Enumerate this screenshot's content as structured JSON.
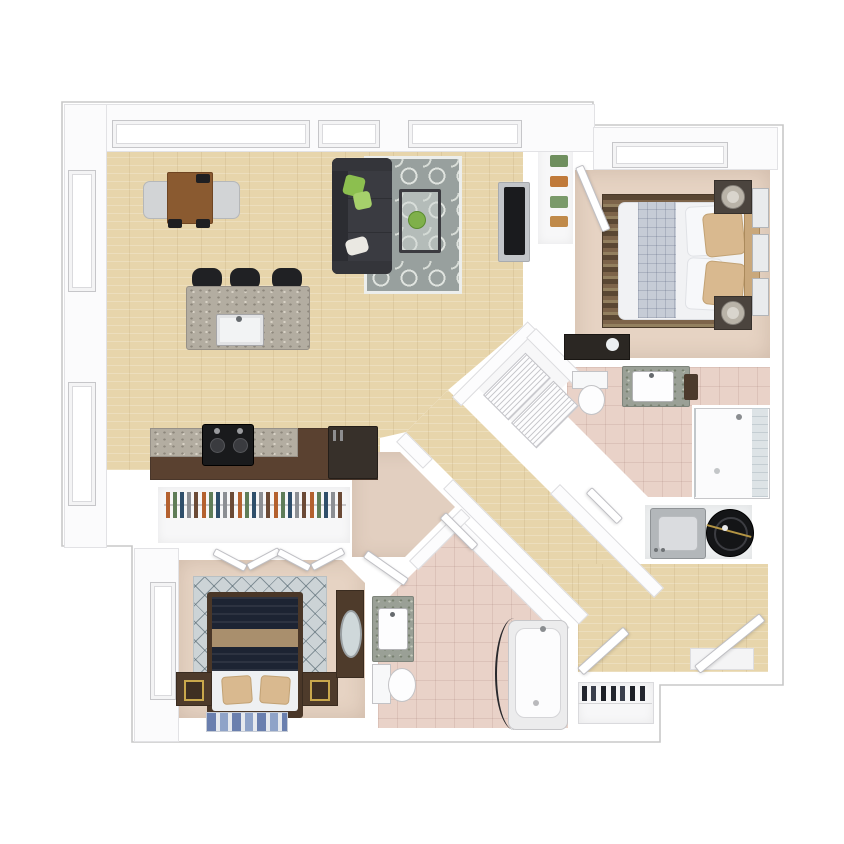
{
  "scene": {
    "type": "3d-floor-plan-render",
    "view": "top-down",
    "description": "Two bedroom, two bathroom apartment rendered in 3D top-down view on white background"
  },
  "palette": {
    "background": "#ffffff",
    "outline": "#c8c8c8",
    "wall": "#fbfbfc",
    "wood_floor": "#e7d5ab",
    "carpet_bedroom": "#e6d3c3",
    "carpet_vestibule": "#e2cfc0",
    "tile_bath": "#e9d2c8",
    "closet_floor": "#f7f7f8",
    "utility_floor": "#eef0f1",
    "sofa": "#3a3b41",
    "rug_living": "#98a09e",
    "dining_table": "#8a5a30",
    "dining_chair": "#d2d4d6",
    "bar_stool": "#202124",
    "counter_cabinet": "#5a4130",
    "range": "#191a1c",
    "refrigerator": "#37302a",
    "tv": "#1a1b1e",
    "tv_mount": "#c2c5c9",
    "master_bed_duvet": "#1d2433",
    "master_bed_band": "#a98f6d",
    "master_bed_linen": "#eef0f2",
    "bed_frame": "#4a3728",
    "nightstand_dark": "#4e3b2b",
    "accent_gold": "#c9a84c",
    "rug_diamond": "#ccd3d6",
    "bed2_duvet": "#f1f2f4",
    "bed2_blanket": "#c6ccd6",
    "bed2_pillow": "#d9b98f",
    "headboard": "#c9a87c",
    "nightstand2": "#4b443e",
    "fixture_white": "#f7f8f9",
    "towel": "#4c3a2c",
    "washer": "#b3b7ba",
    "dryer": "#141517",
    "shower_tile": "#dde3e6",
    "console_dark": "#2b2723",
    "pillow_green_a": "#8cbf4f",
    "pillow_green_b": "#a6d06b"
  },
  "rooms": [
    {
      "id": "living-dining-kitchen",
      "floor": "hardwood"
    },
    {
      "id": "hallway",
      "floor": "hardwood"
    },
    {
      "id": "entry",
      "floor": "hardwood"
    },
    {
      "id": "master-bedroom",
      "floor": "carpet"
    },
    {
      "id": "master-suite-vestibule",
      "floor": "carpet"
    },
    {
      "id": "walk-in-closet",
      "floor": "carpet"
    },
    {
      "id": "master-bathroom",
      "floor": "tile"
    },
    {
      "id": "bedroom-2",
      "floor": "carpet"
    },
    {
      "id": "hall-bathroom",
      "floor": "tile"
    },
    {
      "id": "linen-closet",
      "floor": "white"
    },
    {
      "id": "laundry-closet",
      "floor": "white"
    },
    {
      "id": "coat-closet",
      "floor": "white"
    },
    {
      "id": "bedroom-2-linen-closet",
      "floor": "white"
    }
  ],
  "furniture": {
    "living_dining_kitchen": [
      "sectional sofa with green pillows",
      "quatrefoil area rug",
      "glass coffee table with greenery",
      "wall mounted tv",
      "dining table",
      "two dining chairs",
      "kitchen island with sink",
      "three bar stools",
      "range with burners",
      "refrigerator",
      "kitchen counter run"
    ],
    "master_bedroom": [
      "bed with navy duvet and tan band",
      "two nightstands with gold frames",
      "dresser with oval mirror",
      "diamond lattice rug",
      "blue accent runner",
      "walk-in closet hanging clothes",
      "bifold closet doors"
    ],
    "master_bathroom": [
      "granite vanity with sink",
      "toilet",
      "bathtub with curved curtain rod",
      "shower head"
    ],
    "bedroom_2": [
      "bed with white duvet and gray blanket",
      "tan accent pillows",
      "tan headboard",
      "two nightstands with lamps",
      "striped brown rug",
      "dark media console",
      "three wall frames"
    ],
    "hall_bathroom": [
      "granite vanity with sink",
      "toilet",
      "walk-in tiled shower"
    ],
    "laundry_closet": [
      "washer",
      "dryer drum"
    ],
    "entry": [
      "open front door",
      "door mat",
      "coat closet door",
      "shoe shelf with shoes"
    ],
    "linen_closet": [
      "two wire shelf baskets"
    ],
    "bedroom_2_linen_closet": [
      "folded linens in green and orange"
    ]
  }
}
